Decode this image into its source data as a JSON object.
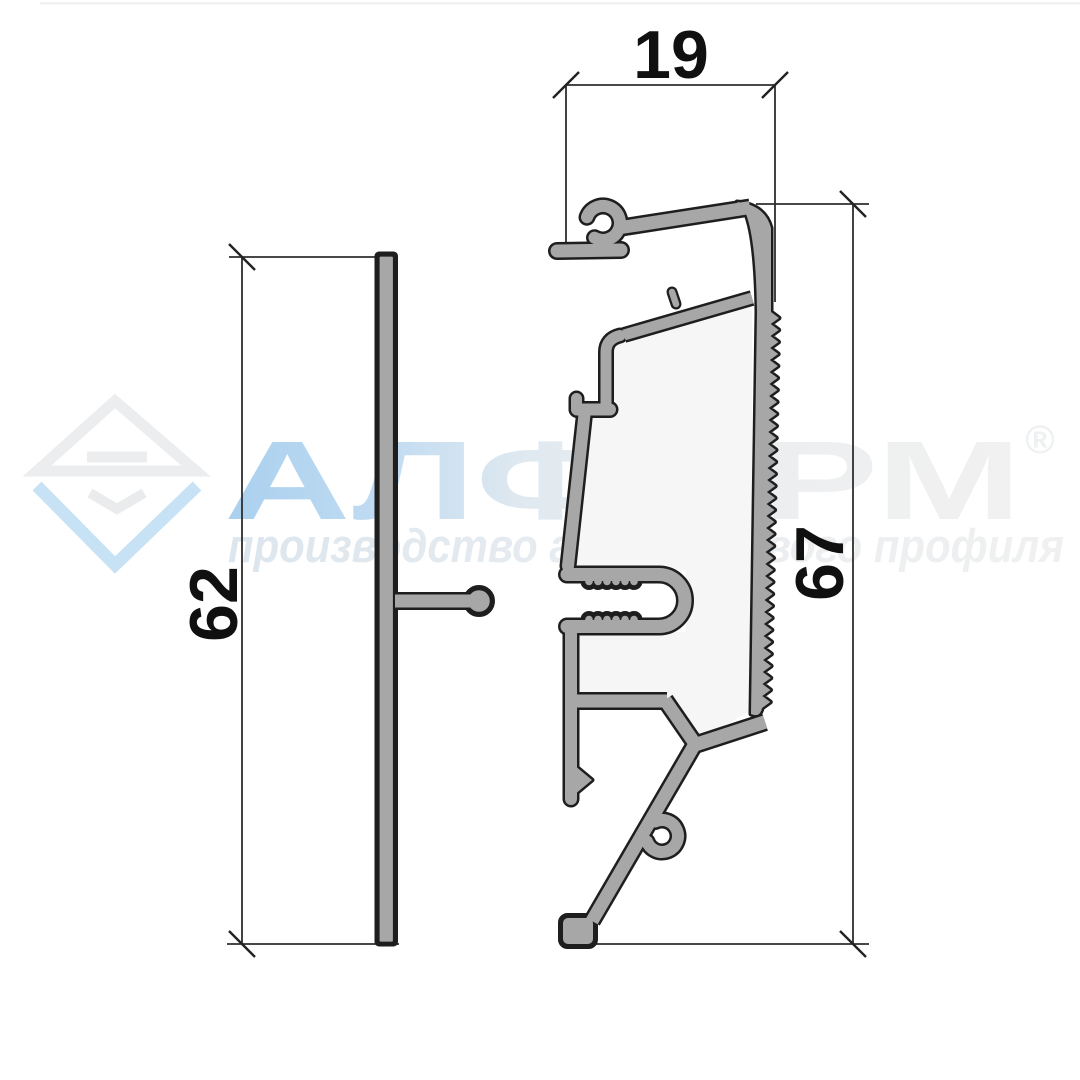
{
  "title": "Aluminium profile cross-section drawing",
  "dimensions": {
    "top_width": "19",
    "left_height": "62",
    "right_height": "67"
  },
  "watermark": {
    "brand": "АЛФОРМ",
    "registered_mark": "®",
    "tagline": "производство алюминиевого профиля"
  },
  "colors": {
    "profile_fill": "#a7a7a7",
    "profile_outline": "#1e1e1e",
    "dimension_lines": "#2e2e2e",
    "watermark_blue": "#b5d8f1",
    "watermark_gray": "#eceef0",
    "interior_tint": "#f6f6f6"
  }
}
